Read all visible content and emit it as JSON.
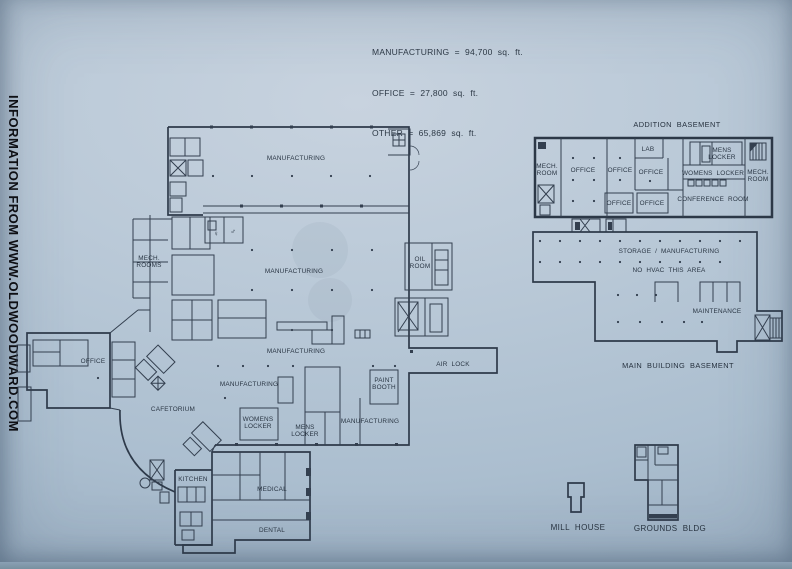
{
  "watermark": "INFORMATION FROM WWW.OLDWOODWARD.COM",
  "stats": {
    "manufacturing": "MANUFACTURING  =  94,700  sq.  ft.",
    "office": "OFFICE  =  27,800  sq.  ft.",
    "other": "OTHER  =  65,869  sq.  ft."
  },
  "main_floor": {
    "manufacturing_top": "MANUFACTURING",
    "manufacturing_mid": "MANUFACTURING",
    "manufacturing_low": "MANUFACTURING",
    "manufacturing_sw": "MANUFACTURING",
    "manufacturing_se": "MANUFACTURING",
    "mech_rooms_line1": "MECH.",
    "mech_rooms_line2": "ROOMS",
    "oil_room_line1": "OIL",
    "oil_room_line2": "ROOM",
    "air_lock": "AIR  LOCK",
    "office": "OFFICE",
    "cafetorium": "CAFETORIUM",
    "womens_locker_line1": "WOMENS",
    "womens_locker_line2": "LOCKER",
    "mens_locker_line1": "MENS",
    "mens_locker_line2": "LOCKER",
    "paint_booth_line1": "PAINT",
    "paint_booth_line2": "BOOTH",
    "kitchen": "KITCHEN",
    "medical": "MEDICAL",
    "dental": "DENTAL",
    "womens_symbol": "♀",
    "mens_symbol": "♂"
  },
  "addition_basement": {
    "title": "ADDITION  BASEMENT",
    "mech_room_left_line1": "MECH.",
    "mech_room_left_line2": "ROOM",
    "office_1": "OFFICE",
    "office_2": "OFFICE",
    "office_3": "OFFICE",
    "office_4": "OFFICE",
    "office_5": "OFFICE",
    "lab": "LAB",
    "mens_locker_line1": "MENS",
    "mens_locker_line2": "LOCKER",
    "womens_locker": "WOMENS  LOCKER",
    "conference_room": "CONFERENCE  ROOM",
    "mech_room_right_line1": "MECH.",
    "mech_room_right_line2": "ROOM"
  },
  "main_basement": {
    "storage": "STORAGE  /  MANUFACTURING",
    "no_hvac": "NO  HVAC  THIS  AREA",
    "maintenance": "MAINTENANCE",
    "caption": "MAIN  BUILDING  BASEMENT"
  },
  "outbuildings": {
    "mill_house": "MILL  HOUSE",
    "grounds_bldg": "GROUNDS  BLDG"
  }
}
